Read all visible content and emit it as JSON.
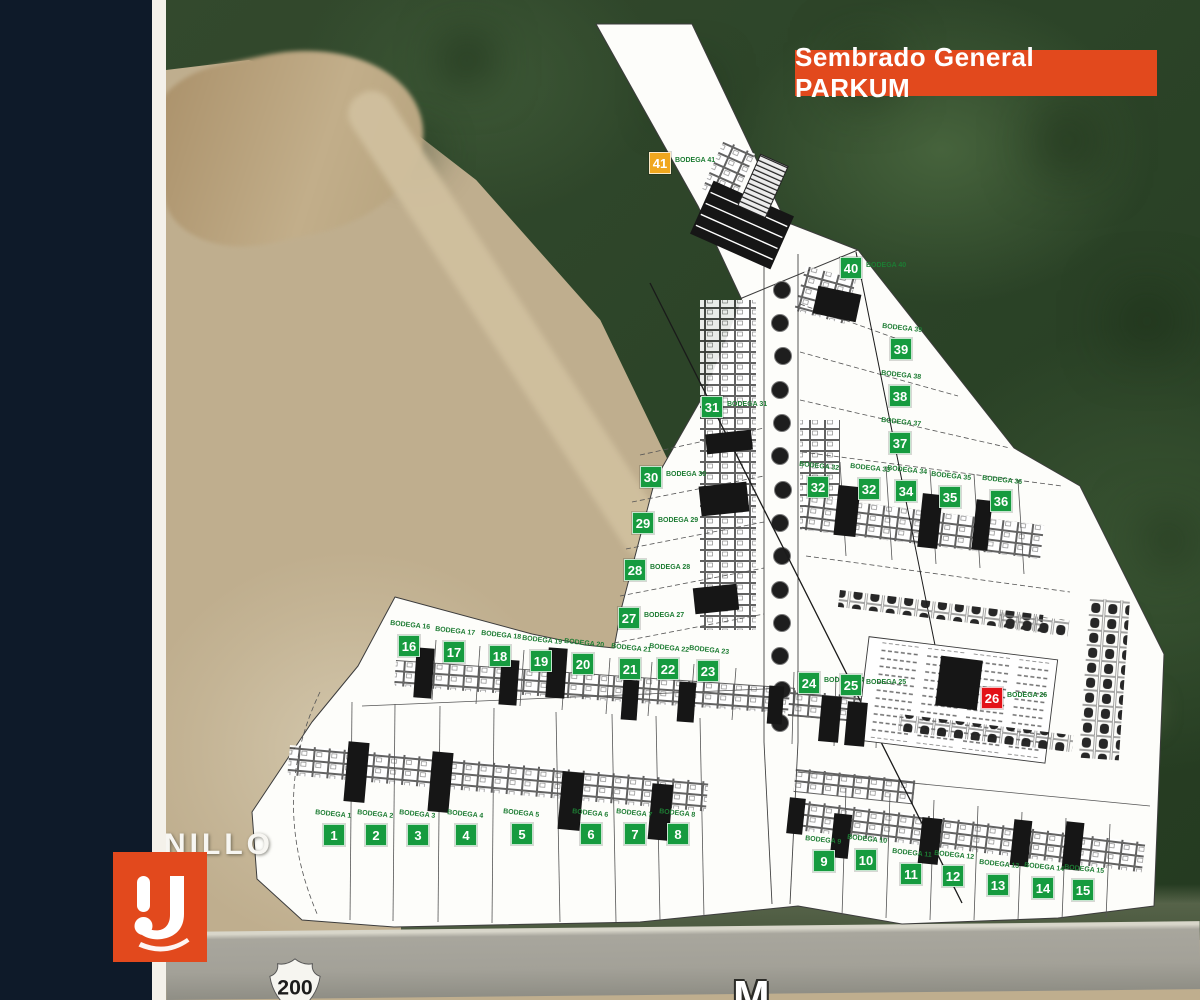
{
  "banner": {
    "title": "Sembrado General PARKUM",
    "bg": "#E2491D",
    "fg": "#FFFFFF"
  },
  "map": {
    "street_label": "NILLO",
    "highway_shield": "200",
    "road_letter": "M"
  },
  "logo": {
    "mark": "U-monogram",
    "bg": "#E2491D"
  },
  "badge_colors": {
    "green": "#169B3F",
    "orange": "#F0A71E",
    "red": "#E31218"
  },
  "lots": [
    {
      "num": "1",
      "label": "BODEGA 1",
      "color": "green",
      "lpos": "above",
      "x": 323,
      "y": 824
    },
    {
      "num": "2",
      "label": "BODEGA 2",
      "color": "green",
      "lpos": "above",
      "x": 365,
      "y": 824
    },
    {
      "num": "3",
      "label": "BODEGA 3",
      "color": "green",
      "lpos": "above",
      "x": 407,
      "y": 824
    },
    {
      "num": "4",
      "label": "BODEGA 4",
      "color": "green",
      "lpos": "above",
      "x": 455,
      "y": 824
    },
    {
      "num": "5",
      "label": "BODEGA 5",
      "color": "green",
      "lpos": "above",
      "x": 511,
      "y": 823
    },
    {
      "num": "6",
      "label": "BODEGA 6",
      "color": "green",
      "lpos": "above",
      "x": 580,
      "y": 823
    },
    {
      "num": "7",
      "label": "BODEGA 7",
      "color": "green",
      "lpos": "above",
      "x": 624,
      "y": 823
    },
    {
      "num": "8",
      "label": "BODEGA 8",
      "color": "green",
      "lpos": "above",
      "x": 667,
      "y": 823
    },
    {
      "num": "9",
      "label": "BODEGA 9",
      "color": "green",
      "lpos": "above",
      "x": 813,
      "y": 850
    },
    {
      "num": "10",
      "label": "BODEGA 10",
      "color": "green",
      "lpos": "above",
      "x": 855,
      "y": 849
    },
    {
      "num": "11",
      "label": "BODEGA 11",
      "color": "green",
      "lpos": "above",
      "x": 900,
      "y": 863
    },
    {
      "num": "12",
      "label": "BODEGA 12",
      "color": "green",
      "lpos": "above",
      "x": 942,
      "y": 865
    },
    {
      "num": "13",
      "label": "BODEGA 13",
      "color": "green",
      "lpos": "above",
      "x": 987,
      "y": 874
    },
    {
      "num": "14",
      "label": "BODEGA 14",
      "color": "green",
      "lpos": "above",
      "x": 1032,
      "y": 877
    },
    {
      "num": "15",
      "label": "BODEGA 15",
      "color": "green",
      "lpos": "above",
      "x": 1072,
      "y": 879
    },
    {
      "num": "16",
      "label": "BODEGA 16",
      "color": "green",
      "lpos": "above",
      "x": 398,
      "y": 635
    },
    {
      "num": "17",
      "label": "BODEGA 17",
      "color": "green",
      "lpos": "above",
      "x": 443,
      "y": 641
    },
    {
      "num": "18",
      "label": "BODEGA 18",
      "color": "green",
      "lpos": "above",
      "x": 489,
      "y": 645
    },
    {
      "num": "19",
      "label": "BODEGA 19",
      "color": "green",
      "lpos": "above",
      "x": 530,
      "y": 650
    },
    {
      "num": "20",
      "label": "BODEGA 20",
      "color": "green",
      "lpos": "above",
      "x": 572,
      "y": 653
    },
    {
      "num": "21",
      "label": "BODEGA 21",
      "color": "green",
      "lpos": "above",
      "x": 619,
      "y": 658
    },
    {
      "num": "22",
      "label": "BODEGA 22",
      "color": "green",
      "lpos": "above",
      "x": 657,
      "y": 658
    },
    {
      "num": "23",
      "label": "BODEGA 23",
      "color": "green",
      "lpos": "above",
      "x": 697,
      "y": 660
    },
    {
      "num": "24",
      "label": "BODEGA 24",
      "color": "green",
      "lpos": "right",
      "x": 798,
      "y": 672
    },
    {
      "num": "25",
      "label": "BODEGA 25",
      "color": "green",
      "lpos": "right",
      "x": 840,
      "y": 674
    },
    {
      "num": "26",
      "label": "BODEGA 26",
      "color": "red",
      "lpos": "right",
      "x": 981,
      "y": 687
    },
    {
      "num": "27",
      "label": "BODEGA 27",
      "color": "green",
      "lpos": "right",
      "x": 618,
      "y": 607
    },
    {
      "num": "28",
      "label": "BODEGA 28",
      "color": "green",
      "lpos": "right",
      "x": 624,
      "y": 559
    },
    {
      "num": "29",
      "label": "BODEGA 29",
      "color": "green",
      "lpos": "right",
      "x": 632,
      "y": 512
    },
    {
      "num": "30",
      "label": "BODEGA 30",
      "color": "green",
      "lpos": "right",
      "x": 640,
      "y": 466
    },
    {
      "num": "31",
      "label": "BODEGA 31",
      "color": "green",
      "lpos": "right",
      "x": 701,
      "y": 396
    },
    {
      "num": "32",
      "label": "BODEGA 32",
      "color": "green",
      "lpos": "above",
      "x": 807,
      "y": 476
    },
    {
      "num": "32",
      "label": "BODEGA 33",
      "color": "green",
      "lpos": "above",
      "x": 858,
      "y": 478
    },
    {
      "num": "34",
      "label": "BODEGA 34",
      "color": "green",
      "lpos": "above",
      "x": 895,
      "y": 480
    },
    {
      "num": "35",
      "label": "BODEGA 35",
      "color": "green",
      "lpos": "above",
      "x": 939,
      "y": 486
    },
    {
      "num": "36",
      "label": "BODEGA 36",
      "color": "green",
      "lpos": "above",
      "x": 990,
      "y": 490
    },
    {
      "num": "37",
      "label": "BODEGA 37",
      "color": "green",
      "lpos": "above",
      "x": 889,
      "y": 432
    },
    {
      "num": "38",
      "label": "BODEGA 38",
      "color": "green",
      "lpos": "above",
      "x": 889,
      "y": 385
    },
    {
      "num": "39",
      "label": "BODEGA 39",
      "color": "green",
      "lpos": "above",
      "x": 890,
      "y": 338
    },
    {
      "num": "40",
      "label": "BODEGA 40",
      "color": "green",
      "lpos": "right",
      "x": 840,
      "y": 257
    },
    {
      "num": "41",
      "label": "BODEGA 41",
      "color": "orange",
      "lpos": "right",
      "x": 649,
      "y": 152
    }
  ]
}
